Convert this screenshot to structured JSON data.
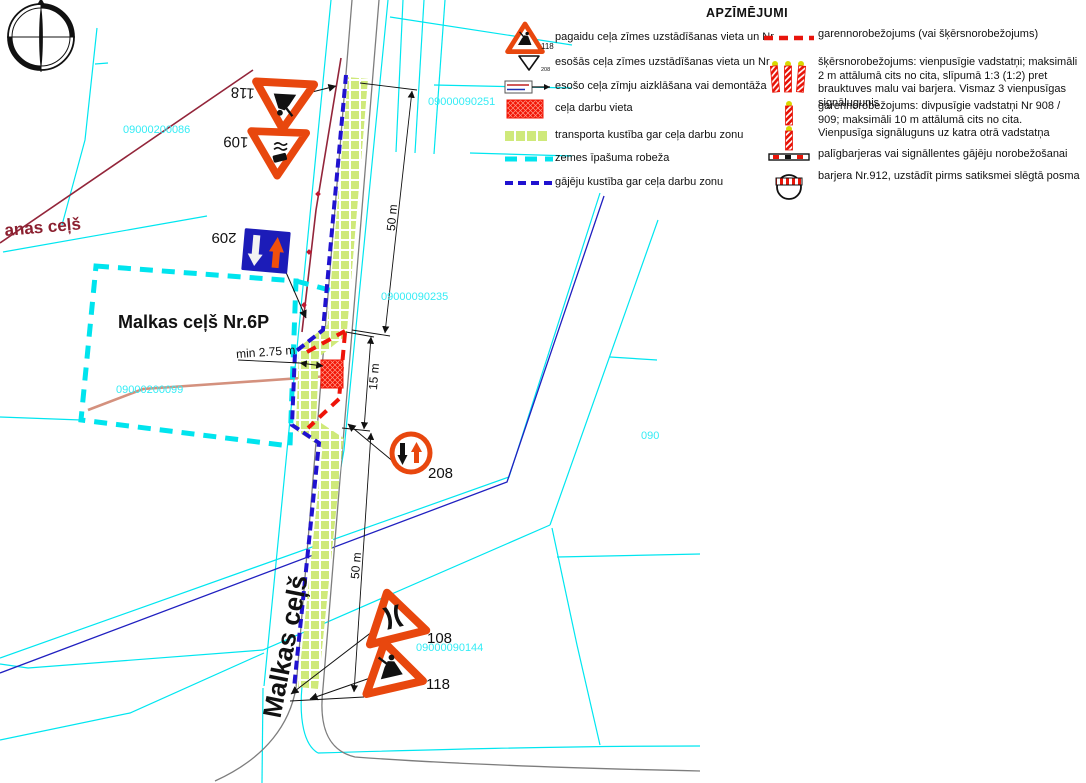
{
  "legend": {
    "title": "APZĪMĒJUMI",
    "items_left": [
      {
        "icon": "temporary-sign-118-icon",
        "number": "118",
        "label": "pagaidu ceļa zīmes uzstādīšanas vieta un Nr"
      },
      {
        "icon": "existing-sign-icon",
        "number": "208",
        "label": "esošās ceļa zīmes uzstādīšanas vieta un Nr"
      },
      {
        "icon": "covered-sign-icon",
        "label": "esošo ceļa zīmju aizklāšana vai demontāža"
      },
      {
        "icon": "work-area-icon",
        "label": "ceļa darbu vieta"
      },
      {
        "icon": "traffic-strip-icon",
        "label": "transporta kustība gar ceļa darbu zonu"
      },
      {
        "icon": "property-boundary-icon",
        "label": "zemes īpašuma robeža"
      },
      {
        "icon": "pedestrian-route-icon",
        "label": "gājēju kustība gar ceļa darbu zonu"
      }
    ],
    "items_right": [
      {
        "icon": "longitudinal-barrier-line-icon",
        "label": "garennorobežojums (vai šķērsnorobežojums)"
      },
      {
        "icon": "guide-posts-three-icon",
        "label": "šķērsnorobežojums: vienpusīgie vadstatņi; maksimāli 2 m attālumā cits no cita, slīpumā 1:3 (1:2) pret brauktuves malu vai barjera. Vismaz 3 vienpusīgas signālugunis"
      },
      {
        "icon": "guide-posts-two-icon",
        "label": "garennorobežojums: divpusīgie vadstatņi Nr 908 / 909; maksimāli 10 m attālumā cits no cita. Vienpusīga signāluguns uz katra otrā vadstatņa"
      },
      {
        "icon": "auxiliary-barrier-icon",
        "label": "palīgbarjeras vai signāllentes gājēju norobežošanai"
      },
      {
        "icon": "barrier-912-icon",
        "label": "barjera Nr.912, uzstādīt pirms satiksmei slēgtā posma"
      }
    ]
  },
  "map": {
    "labels": {
      "parcel_road": "Malkas ceļš Nr.6P",
      "road_vertical": "Malkas ceļš",
      "road_left": "anas ceļš",
      "min_width": "min 2.75 m"
    },
    "dimensions": {
      "top": "50 m",
      "middle": "15 m",
      "bottom": "50 m"
    },
    "cadastral": {
      "c1": "09000200086",
      "c2": "09000090251",
      "c3": "09000090235",
      "c4": "09000200099",
      "c5": "09000090144",
      "c6": "090"
    },
    "signs": {
      "s118_top": "118",
      "s109": "109",
      "s209": "209",
      "s208": "208",
      "s108": "108",
      "s118_bottom": "118"
    }
  },
  "colors": {
    "cyan_boundary": "#00e6f0",
    "sign_orange": "#e8470e",
    "work_red": "#ee1409",
    "pedestrian_blue": "#2012d0",
    "strip_green": "#cfe97a",
    "road_maroon": "#93253a",
    "sign_blue": "#1c1cb8"
  }
}
